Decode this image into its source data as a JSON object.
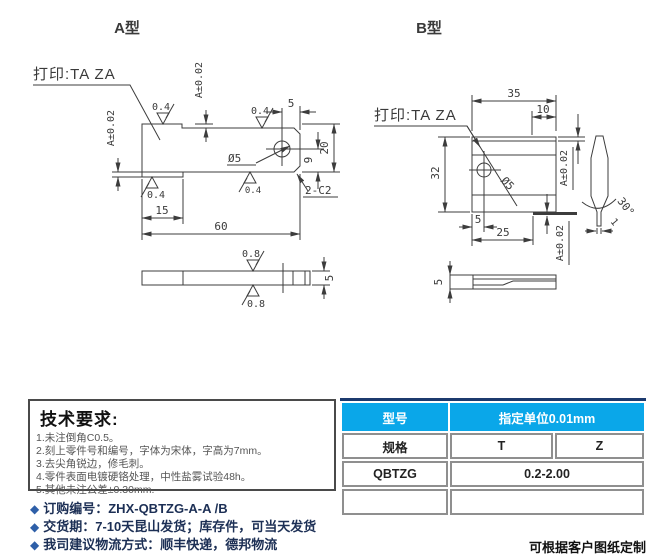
{
  "colors": {
    "line": "#3c3c3c",
    "table_header_blue": "#0aa7e9",
    "table_top_border_navy": "#1c3a6e",
    "bullet_blue": "#2e5fa8",
    "note_text_navy": "#1c2f55"
  },
  "views": {
    "a": {
      "title": "A型",
      "print_label": "打印:TA  ZA",
      "length": "60",
      "height": "20",
      "tab": "15",
      "hole_edge": "5",
      "hole_bottom": "9",
      "hole_dia": "Ø5",
      "chamfer": "2-C2",
      "tol_step_top": "A±0.02",
      "tol_step_left": "A±0.02",
      "rough_04": "0.4",
      "rough_08": "0.8",
      "thickness": "5"
    },
    "b": {
      "title": "B型",
      "print_label": "打印:TA  ZA",
      "width": "35",
      "edge_width": "10",
      "height": "32",
      "hole_offset": "5",
      "hole_span": "25",
      "hole_dia": "Ø5",
      "tol_top": "A±0.02",
      "tol_edge": "A±0.02",
      "edge_angle": "30°",
      "tip_width": "1",
      "thickness": "5"
    }
  },
  "tech": {
    "title": "技术要求:",
    "items": [
      "1.未注倒角C0.5。",
      "2.刻上零件号和编号，字体为宋体，字高为7mm。",
      "3.去尖角锐边，修毛刺。",
      "4.零件表面电镀硬铬处理，中性盐雾试验48h。",
      "5.其他未注公差±0.30mm."
    ]
  },
  "spec_table": {
    "model_header": "型号",
    "unit_header": "指定单位0.01mm",
    "spec_label": "规格",
    "col_t": "T",
    "col_z": "Z",
    "model_value": "QBTZG",
    "range_value": "0.2-2.00"
  },
  "order": {
    "bullet": "◆",
    "items": [
      "订购编号：ZHX-QBTZG-A-A /B",
      "交货期：7-10天昆山发货；库存件，可当天发货",
      "我司建议物流方式：顺丰快递，德邦物流"
    ]
  },
  "footer": {
    "note": "可根据客户图纸定制"
  }
}
